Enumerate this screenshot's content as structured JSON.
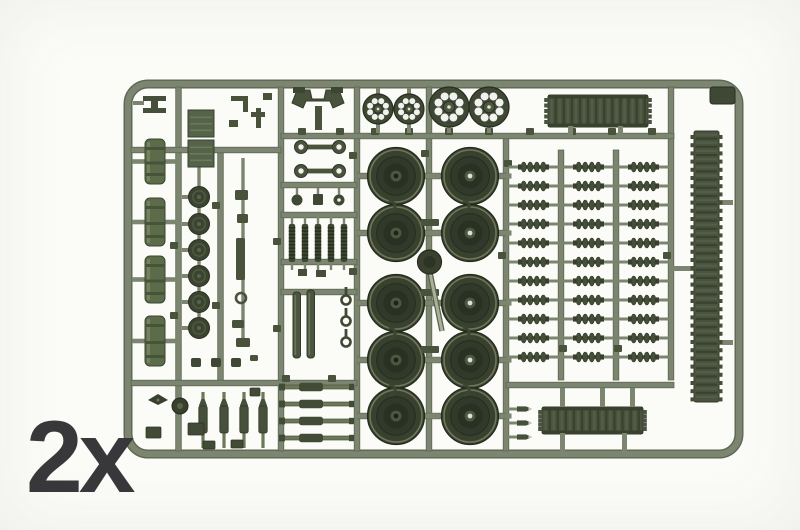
{
  "image_type": "photograph of an injection-molded model kit parts sprue",
  "quantity_label": "2x",
  "palette": {
    "background": "#fbfbf8",
    "runner": "#7b8570",
    "runner_dark": "#5d6752",
    "runner_light": "#99a189",
    "part_dark": "#3f4834",
    "part_darker": "#272e20",
    "part_mid": "#49533c",
    "part_green": "#5c6b49",
    "track_base": "#4a5340",
    "track_rib_dark": "#39422e",
    "track_rib_light": "#545e46",
    "hole": "#f2f2ee",
    "label_color": "#38383a"
  },
  "layout_counts": {
    "sprocket_count": 4,
    "sprocket_holes": 8,
    "wheel_columns": 2,
    "wheel_rows": 5,
    "link_columns": 3,
    "link_rows": 11,
    "fuel_tank_count": 4,
    "hub_disc_count": 6,
    "coil_spring_count": 5,
    "shock_absorber_count": 4,
    "torsion_bar_count": 4,
    "bullet_peg_count": 3,
    "tow_eyelet_rows": 2
  },
  "sprue": {
    "description": "olive-green tank model sprue: drive sprockets, road wheels, track sections, track links, fuel tanks, suspension parts",
    "parts_inventory": [
      {
        "name": "drive-sprocket",
        "count": 4
      },
      {
        "name": "road-wheel",
        "count": 10
      },
      {
        "name": "track-link-cluster",
        "count": 33
      },
      {
        "name": "track-section-horizontal",
        "count": 2
      },
      {
        "name": "track-run-vertical",
        "count": 1
      },
      {
        "name": "fuel-tank",
        "count": 4
      },
      {
        "name": "hub-disc",
        "count": 6
      },
      {
        "name": "coil-spring",
        "count": 5
      },
      {
        "name": "shock-absorber",
        "count": 4
      },
      {
        "name": "torsion-bar",
        "count": 4
      },
      {
        "name": "tow-eyelet",
        "count": 4
      },
      {
        "name": "bullet-peg",
        "count": 3
      }
    ]
  }
}
